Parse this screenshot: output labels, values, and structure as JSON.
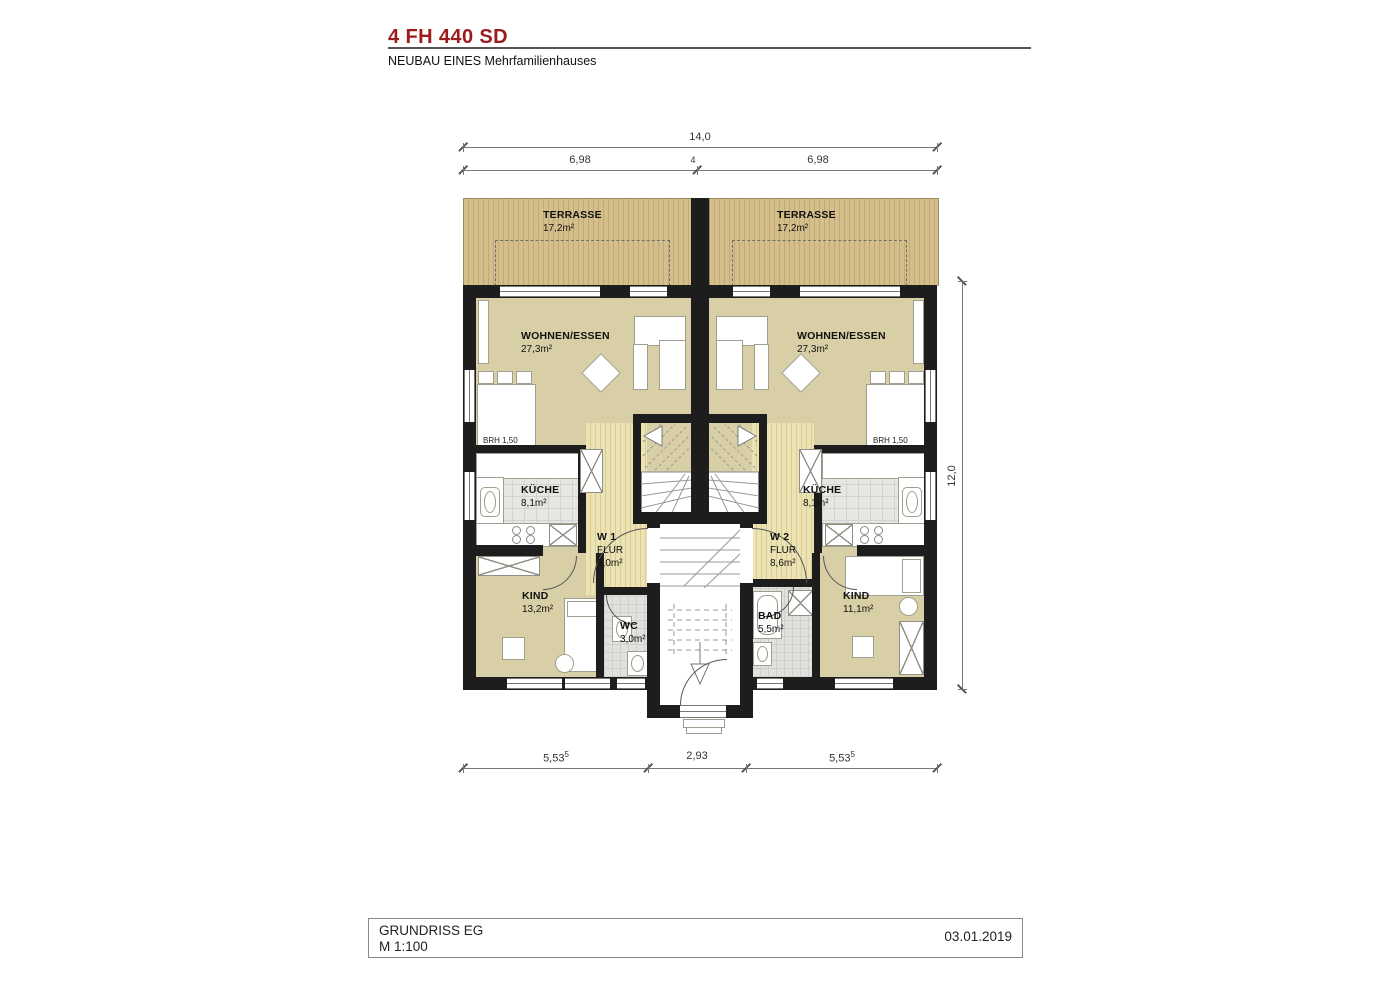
{
  "header": {
    "title": "4 FH 440 SD",
    "subtitle": "NEUBAU EINES Mehrfamilienhauses"
  },
  "footer": {
    "drawing_title": "GRUNDRISS EG",
    "scale": "M 1:100",
    "date": "03.01.2019"
  },
  "dimensions": {
    "top_total": "14,0",
    "top_left": "6,98",
    "top_gap": "4",
    "top_right": "6,98",
    "right_total": "12,0",
    "bottom_left": "5,53",
    "bottom_left_sup": "5",
    "bottom_mid": "2,93",
    "bottom_right": "5,53",
    "bottom_right_sup": "5"
  },
  "units": {
    "w1": "W 1",
    "w2": "W 2"
  },
  "annotations": {
    "brh_left": "BRH 1,50",
    "brh_right": "BRH 1,50"
  },
  "rooms": {
    "terrasse_l": {
      "name": "TERRASSE",
      "area": "17,2m²"
    },
    "terrasse_r": {
      "name": "TERRASSE",
      "area": "17,2m²"
    },
    "wohnen_l": {
      "name": "WOHNEN/ESSEN",
      "area": "27,3m²"
    },
    "wohnen_r": {
      "name": "WOHNEN/ESSEN",
      "area": "27,3m²"
    },
    "kueche_l": {
      "name": "KÜCHE",
      "area": "8,1m²"
    },
    "kueche_r": {
      "name": "KÜCHE",
      "area": "8,1m²"
    },
    "flur_l": {
      "name": "FLUR",
      "area": "9,0m²"
    },
    "flur_r": {
      "name": "FLUR",
      "area": "8,6m²"
    },
    "kind_l": {
      "name": "KIND",
      "area": "13,2m²"
    },
    "kind_r": {
      "name": "KIND",
      "area": "11,1m²"
    },
    "wc": {
      "name": "WC",
      "area": "3,0m²"
    },
    "bad": {
      "name": "BAD",
      "area": "5,5m²"
    }
  },
  "colors": {
    "accent_red": "#9e1b1b",
    "wall": "#1d1d1d",
    "room_beige": "#d8cfa6",
    "terrace": "#d4be8c",
    "flur": "#ece3b5",
    "tile": "#e6e6e3",
    "dimension_line": "#777777"
  }
}
